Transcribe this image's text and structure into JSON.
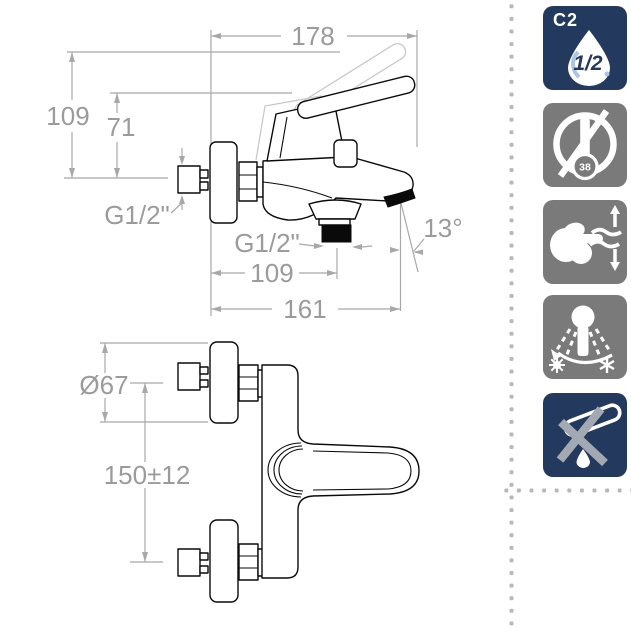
{
  "colors": {
    "navy": "#24395e",
    "icon_gray": "#7a7a7a",
    "line": "#0a0a0a",
    "dim_line": "#a8a8a8",
    "dim_text": "#9b9b9b",
    "phantom": "#c8c8c8",
    "dot": "#b8b8b8",
    "drop_blue": "#aac6e2",
    "x_gray": "#a2a9b2"
  },
  "drawing": {
    "side_view": {
      "name": "bath-shower-mixer-side-elevation",
      "dims": {
        "projection_total": "178",
        "height_to_handle_top": "109",
        "height_to_lever": "71",
        "inlet_thread": "G1/2\"",
        "outlet_thread": "G1/2\"",
        "spout_angle": "13°",
        "outlet_distance": "109",
        "spout_projection": "161"
      }
    },
    "plan_view": {
      "name": "bath-shower-mixer-plan",
      "dims": {
        "escutcheon_diameter": "Ø67",
        "inlet_centres": "150±12"
      }
    }
  },
  "icons": [
    {
      "name": "flow-class-c2-half-inch",
      "label": "C2",
      "value": "1/2",
      "style": "navy"
    },
    {
      "name": "no-thermostatic-limit-38",
      "value": "38",
      "style": "gray"
    },
    {
      "name": "single-lever-flow-control",
      "style": "gray"
    },
    {
      "name": "full-temperature-range-shower",
      "style": "gray"
    },
    {
      "name": "anti-drip-spout",
      "style": "navy"
    }
  ]
}
